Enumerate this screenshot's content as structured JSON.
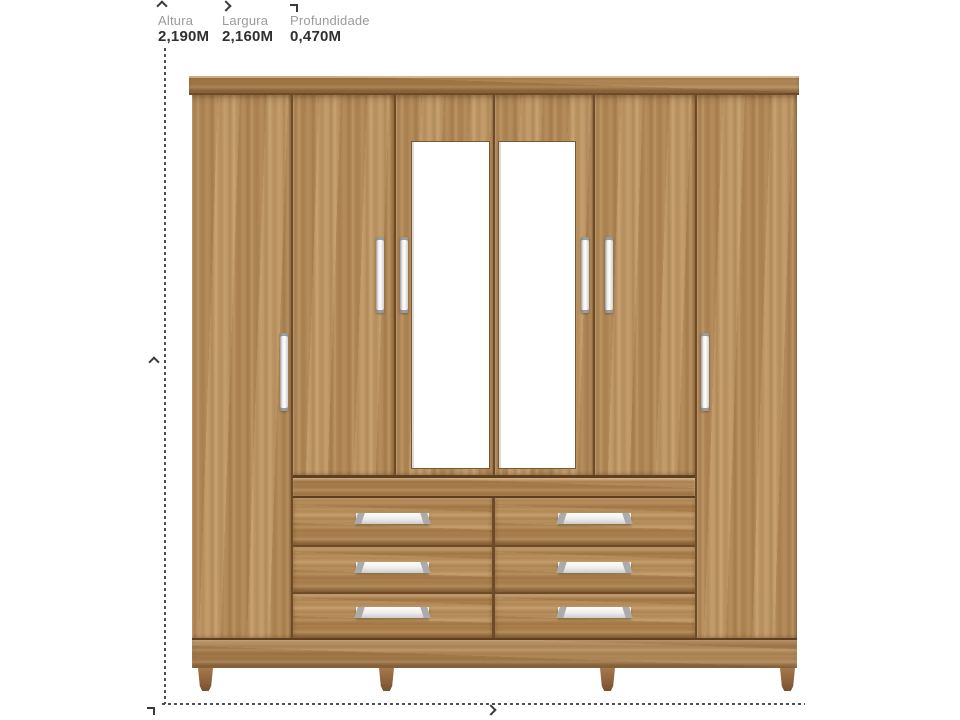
{
  "dimensions": {
    "items": [
      {
        "icon": "arrow-up-icon",
        "label": "Altura",
        "value": "2,190M"
      },
      {
        "icon": "arrow-right-icon",
        "label": "Largura",
        "value": "2,160M"
      },
      {
        "icon": "depth-corner-icon",
        "label": "Profundidade",
        "value": "0,470M"
      }
    ]
  },
  "colors": {
    "background": "#ffffff",
    "label_gray": "#9b9b9b",
    "value_dark": "#303030",
    "dash_line": "#4f4f4f",
    "wood_door": "#b78d5a",
    "wood_crown": "#a67c4b",
    "wood_drawer": "#b28753",
    "wood_dark_divider": "#6e4a27",
    "leg_brown": "#8a5f3a",
    "handle_silver": "#eeeeee",
    "mirror_white": "#ffffff"
  },
  "wardrobe": {
    "doors": 6,
    "mirrored_doors": 2,
    "drawers": 6,
    "drawer_columns": 2,
    "drawer_rows": 3,
    "legs": 4
  }
}
